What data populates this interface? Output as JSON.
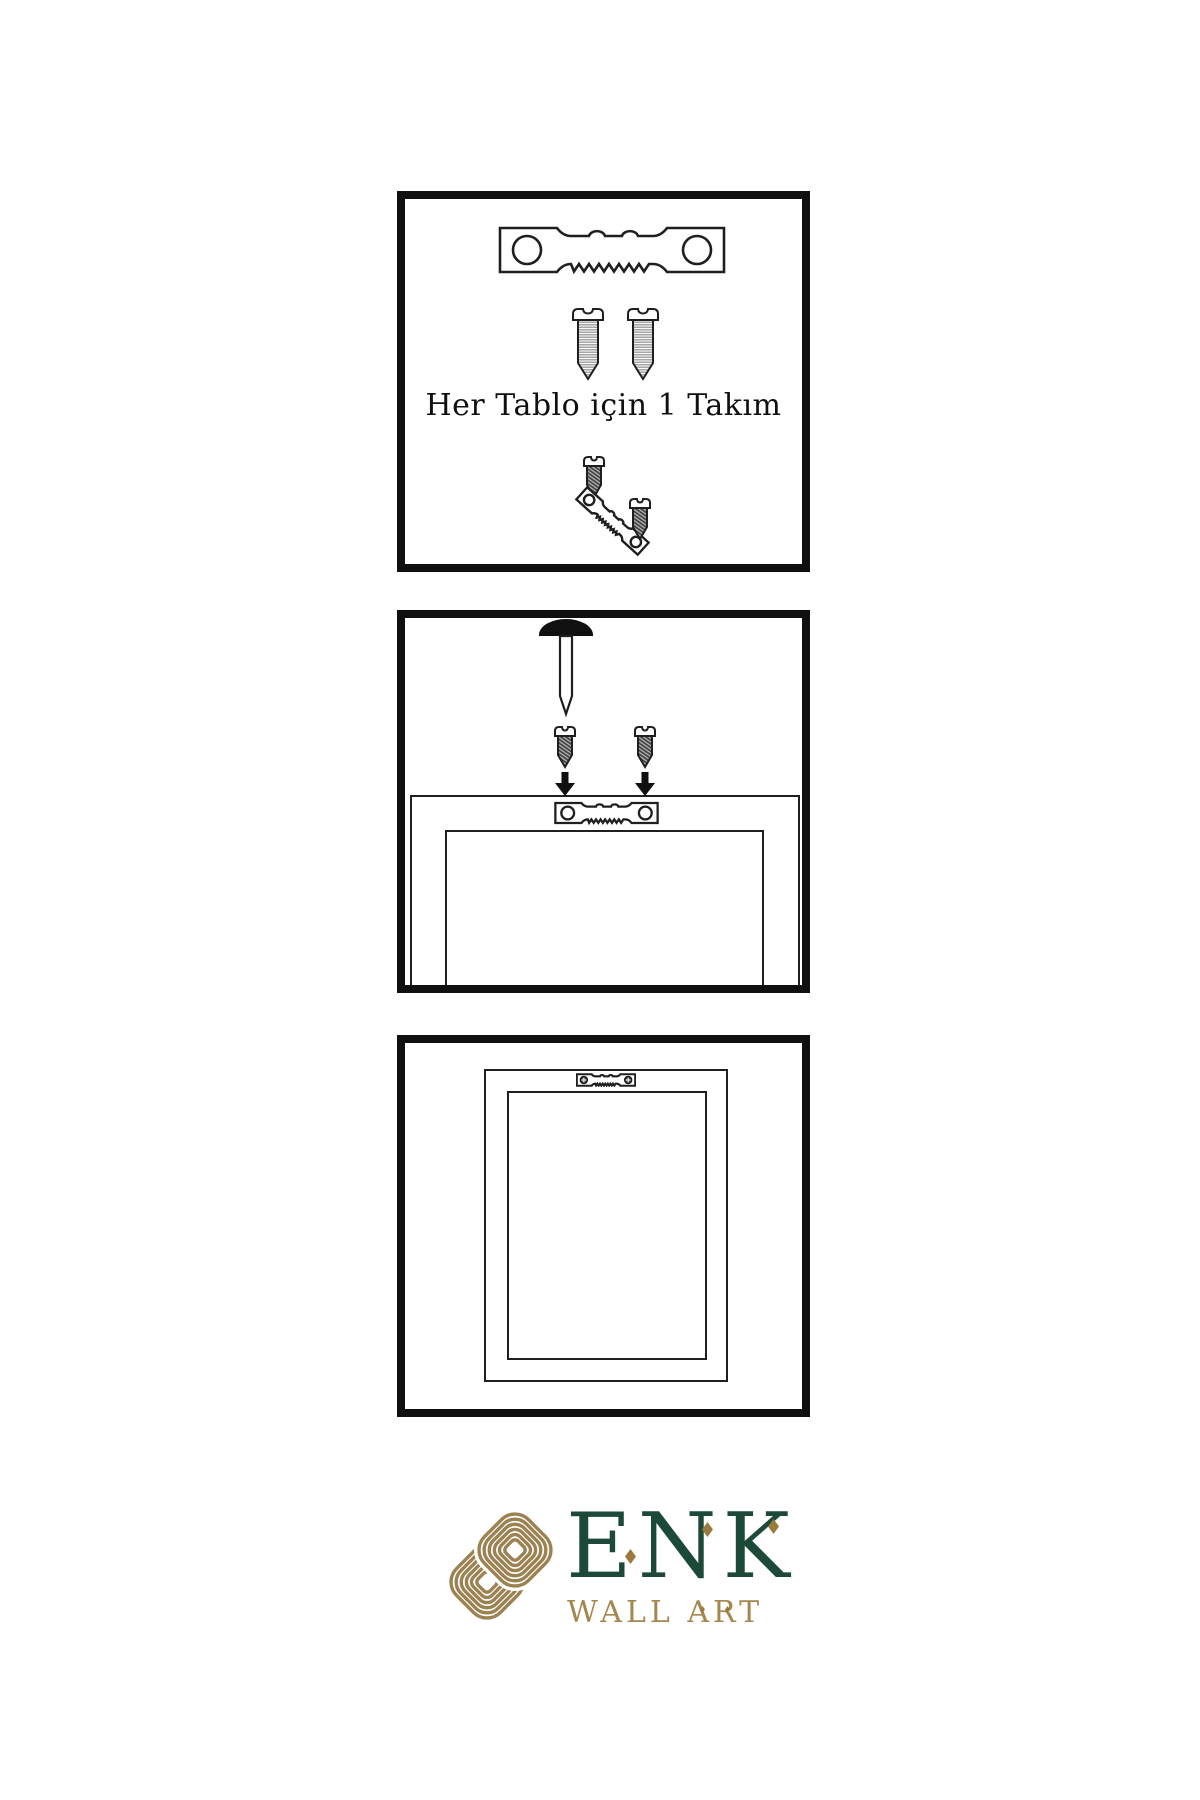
{
  "colors": {
    "paper": "#ffffff",
    "ink": "#101010",
    "line": "#1f1f1f",
    "green": "#1d4938",
    "gold": "#9c8151",
    "gold-text": "#a3874e",
    "gold-diamond": "#9a7b3d"
  },
  "steps": [
    {
      "caption": "Her Tablo için 1 Takım",
      "icons": [
        "sawtooth-hanger",
        "screw",
        "screw",
        "screw",
        "tilted-sawtooth-hanger",
        "screw"
      ]
    },
    {
      "icons": [
        "wall-nail",
        "screw",
        "screw",
        "down-arrow",
        "down-arrow",
        "sawtooth-hanger-on-frame",
        "frame-back"
      ]
    },
    {
      "icons": [
        "hung-frame",
        "mounted-sawtooth-hanger-with-screws"
      ]
    }
  ],
  "logo": {
    "brand": "ENK",
    "subtitle": "WALL ART"
  }
}
